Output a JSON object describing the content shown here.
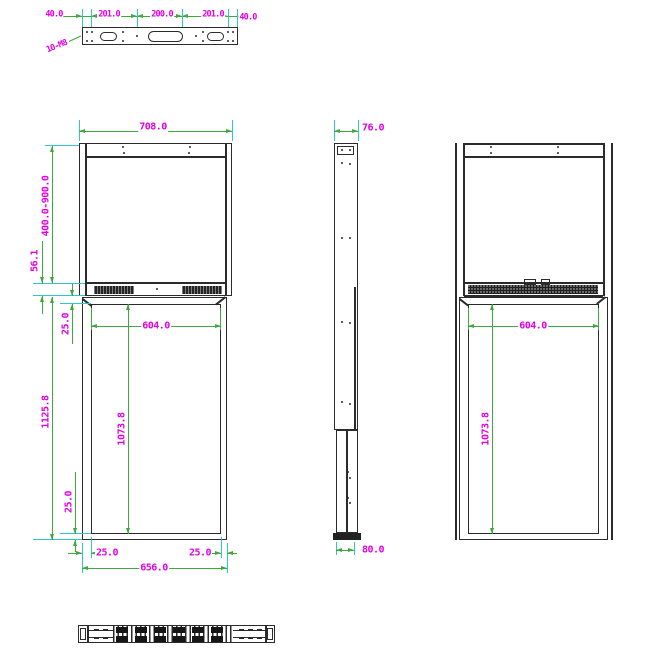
{
  "colors": {
    "outline": "#2b2b2b",
    "dimension_line": "#3da83d",
    "extension_line": "#2bc9c9",
    "dimension_text": "#e000e0"
  },
  "top_view": {
    "dims": [
      "40.0",
      "201.0",
      "200.0",
      "201.0",
      "40.0"
    ],
    "thread_label": "10-M8"
  },
  "front_view": {
    "width": "708.0",
    "mount_height_range": "400.0-900.0",
    "header_height": "56.1",
    "screen_top_inset": "25.0",
    "body_height": "1125.8",
    "screen_bottom_inset": "25.0",
    "screen_width": "604.0",
    "screen_height": "1073.8",
    "bottom_left_inset": "25.0",
    "bottom_right_inset": "25.0",
    "bottom_width": "656.0"
  },
  "side_view": {
    "top_depth": "76.0",
    "bottom_depth": "80.0"
  },
  "back_view": {
    "screen_width": "604.0",
    "screen_height": "1073.8"
  }
}
